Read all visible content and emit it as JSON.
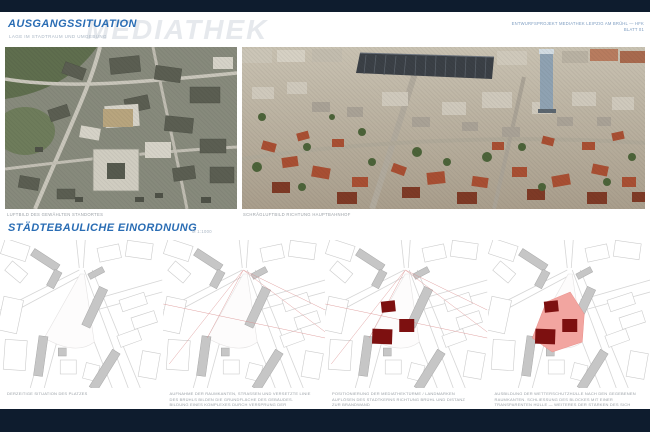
{
  "page": {
    "bar_color": "#0e1c2e",
    "accent_blue": "#2a6db4"
  },
  "header": {
    "title": "AUSGANGSSITUATION",
    "subtitle": "LAGE IM STADTRAUM UND UMGEBUNG",
    "watermark": "MEDIATHEK",
    "meta_line1": "ENTWURFSPROJEKT MEDIATHEK LEIPZIG AM BRÜHL — HFK",
    "meta_line2": "BLATT 01"
  },
  "photos": {
    "left_caption": "LUFTBILD DES GEWÄHLTEN STANDORTES",
    "right_caption": "SCHRÄGLUFTBILD RICHTUNG HAUPTBAHNHOF"
  },
  "section2": {
    "title": "STÄDTEBAULICHE EINORDNUNG",
    "scale": "M 1:1000"
  },
  "maps": {
    "block_color": "#7d1010",
    "site_color": "#f2a5a0",
    "guide_color": "#d98c8c",
    "items": [
      {
        "caption": "DERZEITIGE SITUATION DES PLATZES",
        "layers": {
          "guides": false,
          "site": false,
          "blocks": false
        }
      },
      {
        "caption": "AUFNAHME DER RAUMKANTEN, STRASSEN UND VERSETZTE LINIE DES BRÜHLS BILDEN DIE GRUNDFLÄCHE DES GEBÄUDES. BILDUNG EINES KOMPLEXES DURCH VERSPRUNG DER HÖHENZÜGE DER BEBAUUNG NACH SÜDEN",
        "layers": {
          "guides": true,
          "site": false,
          "blocks": false
        }
      },
      {
        "caption": "POSITIONIERUNG DER MEDIATHEKTÜRME / LANDMARKEN AUFLÖSEN DES STADTKERNS RICHTUNG BRÜHL UND DISTANZ ZUR BRANDWAND",
        "layers": {
          "guides": true,
          "site": false,
          "blocks": true
        }
      },
      {
        "caption": "AUSBILDUNG DER WETTERSCHUTZHÜLLE NACH DEN GEGEBENEN RAUMKANTEN. SCHLIESSUNG DES BLOCKES MIT EINER TRANSPARENTEN HÜLLE — WEITERES DER STÄRKEN DES SICH AUFLÖSENDEN STADTKERNS",
        "layers": {
          "guides": false,
          "site": true,
          "blocks": true
        }
      }
    ]
  }
}
